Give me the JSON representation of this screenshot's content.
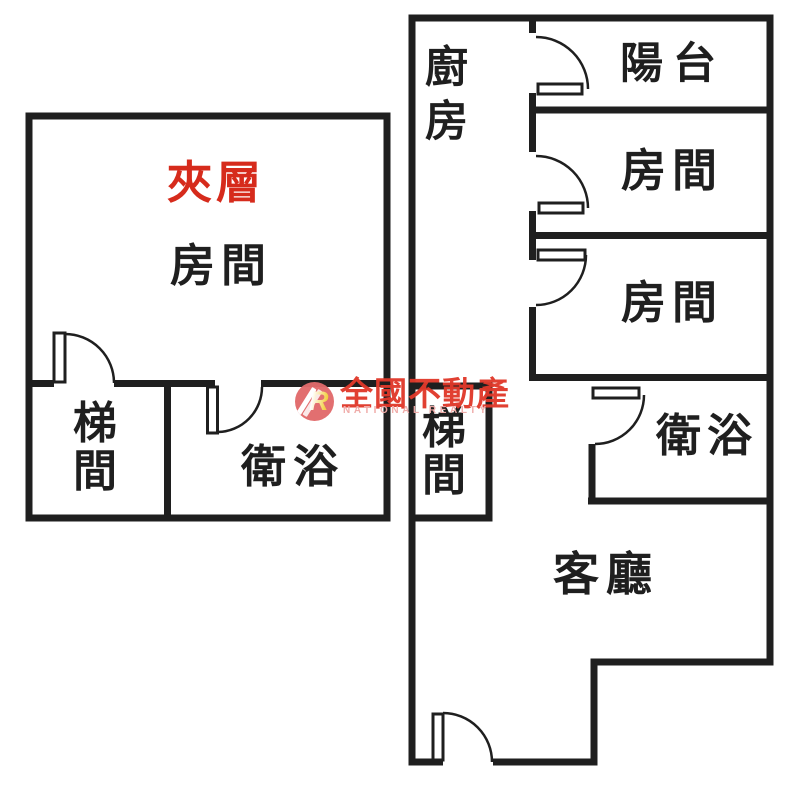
{
  "left_plan": {
    "mezzanine_label": "夾層",
    "room_label": "房間",
    "stair_char1": "梯",
    "stair_char2": "間",
    "bath_label": "衛浴"
  },
  "right_plan": {
    "kitchen_char1": "廚",
    "kitchen_char2": "房",
    "balcony_label": "陽台",
    "room1_label": "房間",
    "room2_label": "房間",
    "bath_label": "衛浴",
    "stair_char1": "梯",
    "stair_char2": "間",
    "living_label": "客廳"
  },
  "watermark": {
    "logo_letter": "R",
    "brand_name": "全國不動產",
    "brand_subtitle": "NATIONAL REALTY",
    "brand_color": "#e0392a",
    "subtitle_color": "#efa9a6",
    "logo_circle_color": "#e16a6b"
  },
  "colors": {
    "wall": "#1f1f1f",
    "mezzanine_text": "#d62b1c",
    "label_text": "#1f1f1f",
    "background": "#ffffff"
  }
}
